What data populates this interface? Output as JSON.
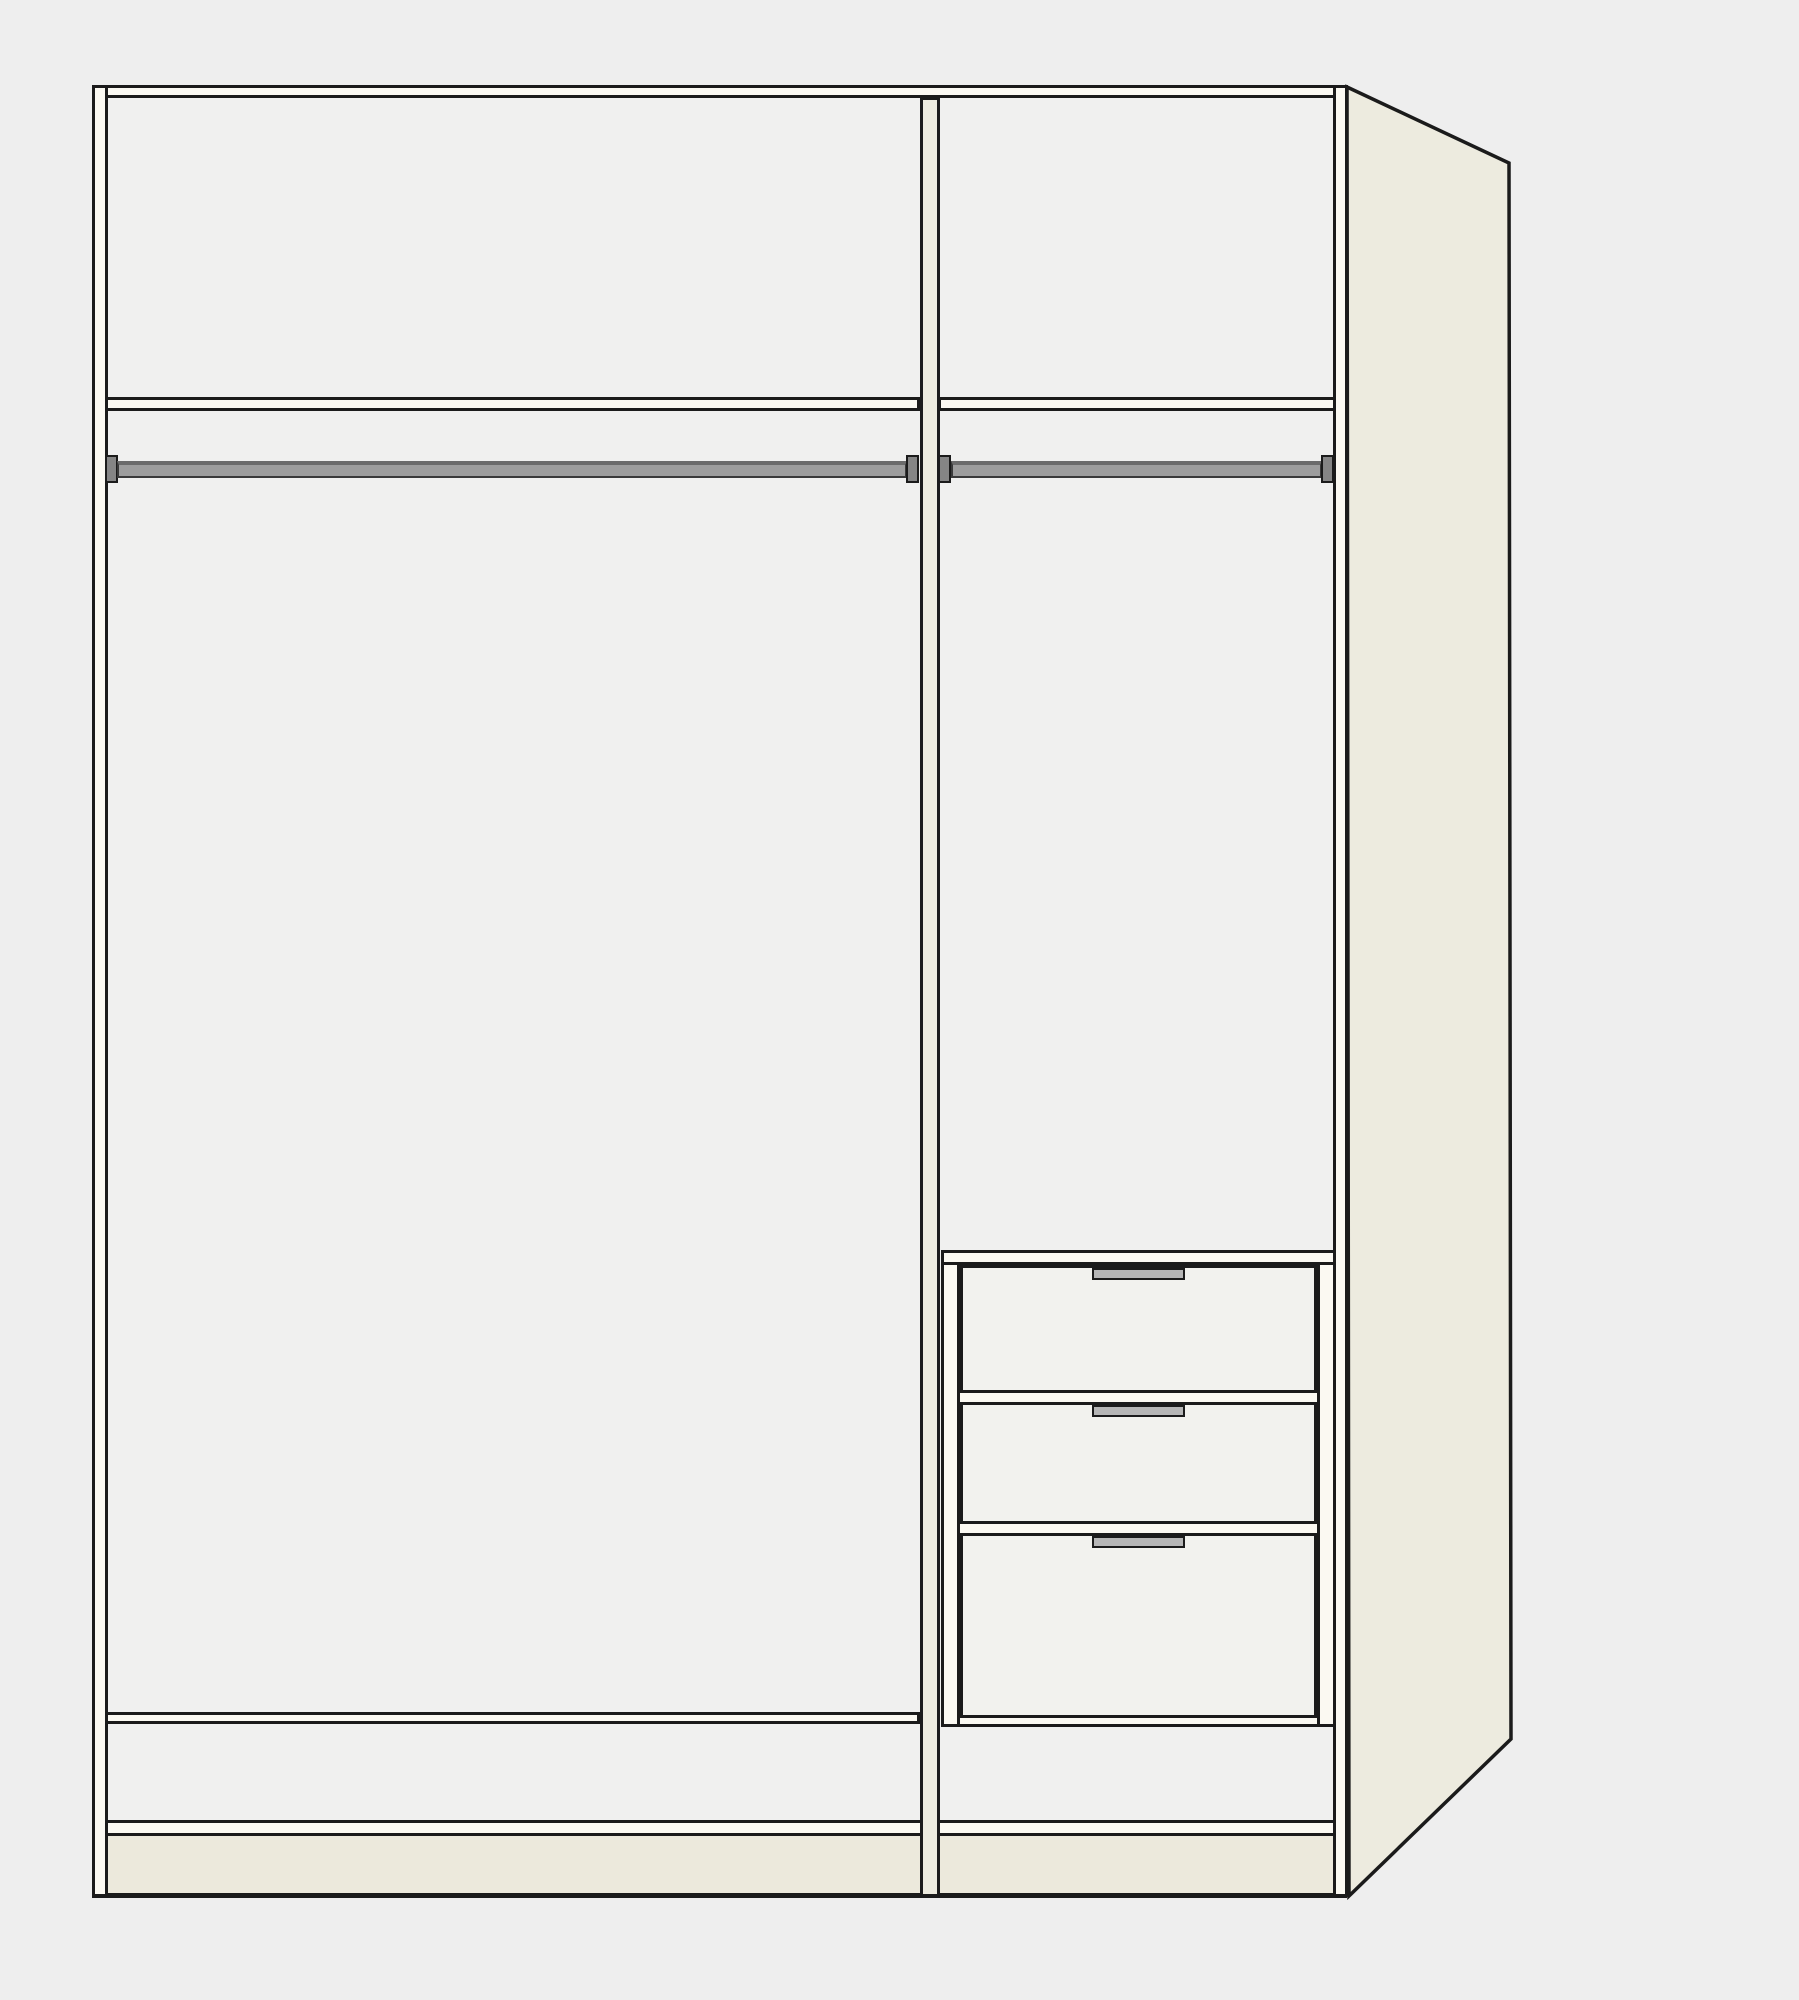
{
  "meta": {
    "title": "Wardrobe interior configuration preview",
    "view": "front elevation with right side panel shown in perspective",
    "visible_text": ""
  },
  "colors": {
    "background": "#eeeeee",
    "interior": "#f0f0ef",
    "line": "#1b1b1b",
    "panel_edge": "#fbf9f2",
    "cream_panel": "#edebdf",
    "plinth": "#ece9dc",
    "drawer_front": "#f2f2ee",
    "rail": "#9d9d9d",
    "rail_top_edge": "#6b6b6b",
    "bracket": "#858585",
    "handle": "#b6b6b6"
  },
  "wardrobe": {
    "section_count": 2,
    "sections": [
      {
        "id": "left",
        "approx_width_ratio": 0.67,
        "contents": [
          "top shelf compartment",
          "clothes rail with end brackets",
          "open hanging space",
          "bottom shelf"
        ]
      },
      {
        "id": "right",
        "approx_width_ratio": 0.33,
        "contents": [
          "top shelf compartment",
          "clothes rail with end brackets",
          "open hanging space",
          "three-drawer unit"
        ]
      }
    ],
    "drawer_unit": {
      "location": "right section, lower half",
      "drawer_count": 3,
      "drawers": [
        {
          "id": "drawer-1",
          "relative_height": "small",
          "handle": "recessed gray pull, centered"
        },
        {
          "id": "drawer-2",
          "relative_height": "small",
          "handle": "recessed gray pull, centered"
        },
        {
          "id": "drawer-3",
          "relative_height": "large",
          "handle": "recessed gray pull, centered"
        }
      ]
    },
    "rails": {
      "count": 2,
      "style": "gray tube with darker end brackets"
    },
    "side_panel": {
      "position": "right",
      "rendering": "perspective, cream colored, angled cut at bottom rear"
    },
    "plinth": {
      "present": true,
      "color_note": "cream base strip across full width"
    }
  }
}
